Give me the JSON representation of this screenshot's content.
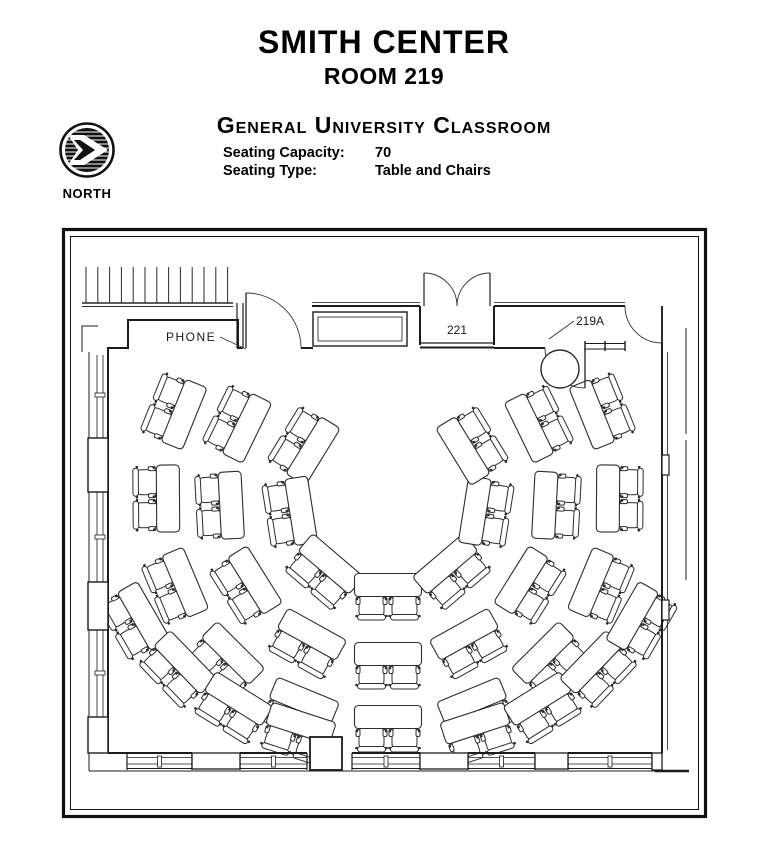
{
  "header": {
    "building": "SMITH CENTER",
    "room": "ROOM 219",
    "classroom_type": "General University Classroom",
    "seating_capacity_label": "Seating Capacity:",
    "seating_capacity_value": "70",
    "seating_type_label": "Seating Type:",
    "seating_type_value": "Table and Chairs"
  },
  "north_arrow": {
    "label": "NORTH"
  },
  "floor_plan": {
    "line_color": "#1f1f1f",
    "labels": {
      "phone": {
        "text": "PHONE"
      },
      "room_221": {
        "text": "221"
      },
      "door_219a": {
        "text": "219A"
      }
    },
    "seating": {
      "table_count": 35,
      "seat_count": 70,
      "seats_per_table": 2,
      "focal": {
        "x": 388,
        "y": 497
      },
      "table": {
        "length": 67,
        "width": 23
      },
      "chair": {
        "width": 25,
        "depth": 21
      },
      "arcs": [
        {
          "r": 88,
          "bearings": [
            -58.5,
            -99,
            -139.5,
            180,
            139.5,
            99,
            58.5
          ]
        },
        {
          "r": 157,
          "bearings": [
            -64,
            -93,
            -122,
            -151,
            180,
            151,
            122,
            93,
            64
          ]
        },
        {
          "r": 220,
          "bearings": [
            -68,
            -90.4,
            -112.8,
            -135.2,
            -157.6,
            180,
            157.6,
            135.2,
            112.8,
            90.4,
            68
          ]
        },
        {
          "rx": 282,
          "ry": 238,
          "bearings": [
            -120,
            -134,
            -148,
            -162,
            162,
            148,
            134,
            120
          ]
        }
      ]
    }
  }
}
